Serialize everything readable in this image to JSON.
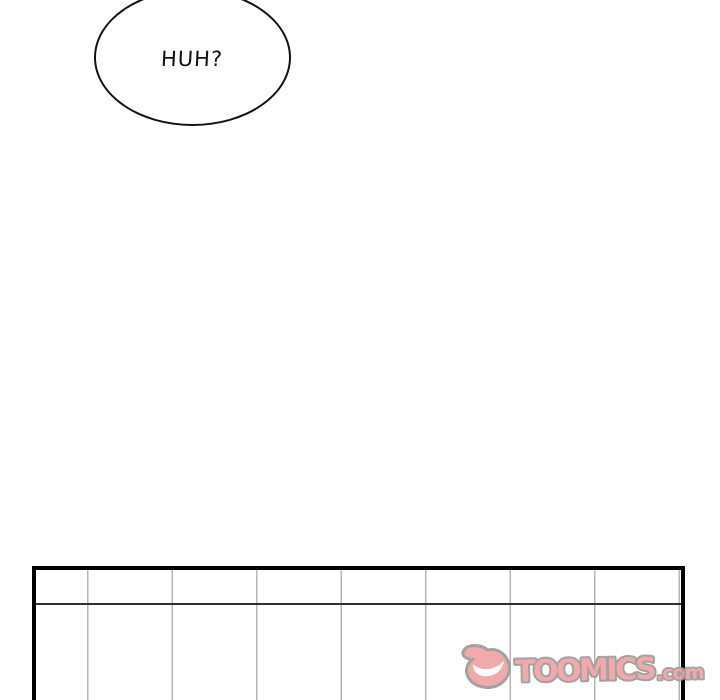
{
  "comic": {
    "speech_bubble": {
      "text": "HUH?"
    },
    "panel": {
      "description": "empty panel with vertical fence lines and one horizontal rail line"
    },
    "watermark": {
      "brand": "TOOMICS",
      "suffix": ".com",
      "icon": "toomics-devil-icon"
    }
  },
  "colors": {
    "ink": "#111111",
    "panel_border": "#000000",
    "fence_line": "#b5b5b5",
    "rail_line": "#2f2f2f",
    "watermark_fill": "#f1a3a3",
    "watermark_outline": "#9b9b9b",
    "page_bg": "#ffffff"
  }
}
